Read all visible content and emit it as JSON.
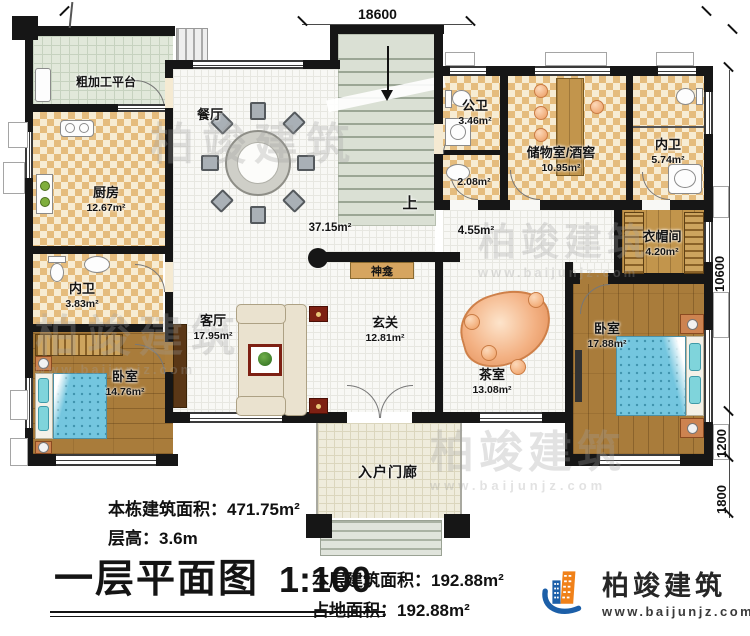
{
  "watermark": {
    "brand": "柏竣建筑",
    "url": "www.baijunjz.com"
  },
  "dimensions": {
    "top": "18600",
    "right_main": "10600",
    "right_mid": "1200",
    "right_bottom": "1800"
  },
  "rooms": {
    "platform": {
      "name": "粗加工平台"
    },
    "kitchen": {
      "name": "厨房",
      "area": "12.67m²"
    },
    "bath_left": {
      "name": "内卫",
      "area": "3.83m²"
    },
    "bedroom_left": {
      "name": "卧室",
      "area": "14.76m²"
    },
    "dining": {
      "name": "餐厅",
      "area": "37.15m²"
    },
    "public_bath": {
      "name": "公卫",
      "area": "3.46m²"
    },
    "basin_nook": {
      "area": "2.08m²"
    },
    "storage": {
      "name": "储物室/酒窖",
      "area": "10.95m²"
    },
    "bath_right": {
      "name": "内卫",
      "area": "5.74m²"
    },
    "cloakroom": {
      "name": "衣帽间",
      "area": "4.20m²"
    },
    "hallway": {
      "area": "4.55m²"
    },
    "foyer": {
      "name": "玄关",
      "area": "12.81m²"
    },
    "living": {
      "name": "客厅",
      "area": "17.95m²"
    },
    "tea_room": {
      "name": "茶室",
      "area": "13.08m²"
    },
    "bedroom_right": {
      "name": "卧室",
      "area": "17.88m²"
    },
    "porch": {
      "name": "入户门廊"
    },
    "shrine": {
      "name": "神龛"
    },
    "stairs": {
      "direction": "上"
    }
  },
  "info": {
    "building_total_area": "本栋建筑面积：471.75m²",
    "floor_height": "层高：3.6m",
    "plan_title": "一层平面图",
    "plan_scale": "1:100",
    "floor_area": "本层建筑面积：192.88m²",
    "footprint_area": "占地面积：192.88m²"
  },
  "logo": {
    "brand": "柏竣建筑",
    "url": "www.baijunjz.com"
  },
  "colors": {
    "wall": "#161616",
    "checker": "#e5bc7d",
    "wood": "#a97c3b",
    "bed": "#74c6df",
    "accent_orange": "#f08119",
    "accent_blue": "#1c5fa8"
  }
}
